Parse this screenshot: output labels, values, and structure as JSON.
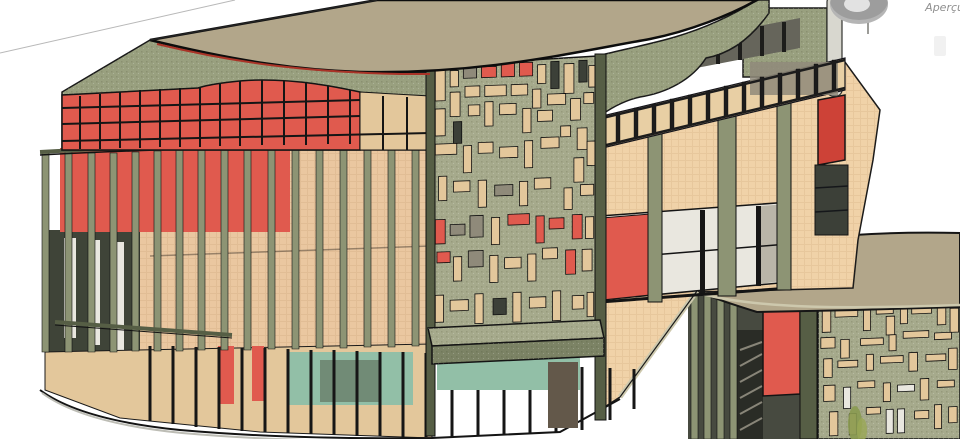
{
  "overlay": {
    "preview_label": "Aperçu",
    "preview_icon": "steering-wheel-icon"
  },
  "palette": {
    "bg": "#ffffff",
    "refline": "#b8b8b8",
    "roof": "#b2a68a",
    "roof_edge": "#0d0d0d",
    "fascia": "#99a07f",
    "fascia_dark": "#7c8365",
    "olive_panel": "#a6aa8c",
    "fin": "#8d9474",
    "fin_dark": "#565e45",
    "peach": "#f0d2a8",
    "peach_wall": "#eac7a0",
    "tan": "#e3c79b",
    "red": "#e05a4e",
    "red_bright": "#cd4237",
    "red_trim": "#a93327",
    "gray_panel": "#8f8a7a",
    "dark_glass": "#3c4038",
    "interior_dark": "#3f4438",
    "teal": "#92bfa7",
    "white_glass": "#e9e7df",
    "pole": "#d8d7cf",
    "slab": "#cdc8ad",
    "door_dark": "#63584a",
    "plant": "#8a9a50",
    "railing_peach": "#e8cfa4",
    "rail_dark": "#22231f",
    "facade2_bg": "#474a40",
    "ui_gray": "#9d9d9d",
    "ui_text": "#8f8f8f"
  },
  "generated": {
    "fins1": [
      [
        42,
        152,
        352
      ],
      [
        65,
        152,
        352
      ],
      [
        88,
        153,
        352
      ],
      [
        110,
        153,
        352
      ],
      [
        132,
        152,
        351
      ],
      [
        154,
        151,
        351
      ],
      [
        176,
        150,
        351
      ],
      [
        198,
        150,
        350
      ],
      [
        221,
        149,
        350
      ],
      [
        244,
        148,
        350
      ],
      [
        268,
        148,
        349
      ],
      [
        292,
        147,
        349
      ],
      [
        316,
        147,
        348
      ],
      [
        340,
        146,
        348
      ],
      [
        364,
        146,
        347
      ],
      [
        388,
        145,
        347
      ],
      [
        412,
        145,
        346
      ]
    ],
    "fins2": [
      [
        691,
        293,
        439
      ],
      [
        704,
        295,
        439
      ],
      [
        717,
        297,
        439
      ],
      [
        730,
        299,
        439
      ]
    ],
    "clerestory_verticals": [
      [
        80,
        96,
        149
      ],
      [
        100,
        94,
        149
      ],
      [
        120,
        92,
        148
      ],
      [
        140,
        90,
        148
      ],
      [
        160,
        89,
        147
      ],
      [
        180,
        88,
        147
      ],
      [
        200,
        87,
        147
      ],
      [
        220,
        84,
        146
      ],
      [
        240,
        81,
        146
      ],
      [
        262,
        80,
        145
      ],
      [
        284,
        81,
        145
      ],
      [
        306,
        83,
        145
      ],
      [
        328,
        86,
        144
      ],
      [
        350,
        90,
        144
      ]
    ],
    "clerestory_horizontals": [
      [
        62,
        108,
        360,
        100
      ],
      [
        62,
        124,
        360,
        116
      ],
      [
        62,
        141,
        430,
        133
      ]
    ],
    "railing_posts": [
      [
        598,
        117
      ],
      [
        616,
        113
      ],
      [
        634,
        108
      ],
      [
        652,
        104
      ],
      [
        670,
        99
      ],
      [
        688,
        95
      ],
      [
        706,
        91
      ],
      [
        724,
        86
      ],
      [
        742,
        82
      ],
      [
        760,
        77
      ],
      [
        778,
        73
      ],
      [
        796,
        69
      ],
      [
        814,
        64
      ],
      [
        832,
        60
      ]
    ],
    "storefront_mullions": [
      [
        150,
        346,
        421
      ],
      [
        173,
        346,
        424
      ],
      [
        196,
        347,
        427
      ],
      [
        219,
        347,
        429
      ],
      [
        242,
        348,
        431
      ],
      [
        265,
        348,
        432
      ],
      [
        288,
        349,
        433
      ],
      [
        311,
        350,
        434
      ],
      [
        334,
        350,
        435
      ],
      [
        357,
        351,
        436
      ],
      [
        380,
        352,
        436
      ],
      [
        403,
        352,
        437
      ],
      [
        426,
        353,
        437
      ],
      [
        452,
        362,
        437
      ],
      [
        478,
        363,
        436
      ],
      [
        504,
        364,
        435
      ],
      [
        530,
        365,
        434
      ],
      [
        556,
        366,
        432
      ],
      [
        582,
        367,
        430
      ],
      [
        610,
        368,
        420
      ],
      [
        634,
        369,
        409
      ]
    ],
    "stair_steps": [
      [
        740,
        430,
        762,
        418
      ],
      [
        740,
        414,
        762,
        402
      ],
      [
        740,
        398,
        762,
        386
      ],
      [
        740,
        382,
        762,
        370
      ],
      [
        740,
        366,
        762,
        354
      ],
      [
        740,
        350,
        762,
        342
      ]
    ],
    "panel1": {
      "transform": "matrix(1.65,-0.061,0,2.7,432,66)",
      "rects": [
        [
          2,
          1,
          6,
          12,
          "t"
        ],
        [
          11,
          2,
          5,
          6,
          "t"
        ],
        [
          19,
          1,
          8,
          4,
          "g"
        ],
        [
          30,
          1,
          9,
          4,
          "r"
        ],
        [
          42,
          0,
          8,
          5,
          "r"
        ],
        [
          53,
          0,
          8,
          5,
          "r"
        ],
        [
          64,
          1,
          5,
          7,
          "t"
        ],
        [
          72,
          0,
          5,
          10,
          "d"
        ],
        [
          80,
          1,
          6,
          11,
          "t"
        ],
        [
          89,
          0,
          5,
          8,
          "d"
        ],
        [
          95,
          2,
          4,
          8,
          "t"
        ],
        [
          11,
          10,
          6,
          9,
          "t"
        ],
        [
          20,
          8,
          9,
          4,
          "t"
        ],
        [
          32,
          8,
          13,
          4,
          "t"
        ],
        [
          48,
          8,
          10,
          4,
          "t"
        ],
        [
          61,
          10,
          5,
          7,
          "t"
        ],
        [
          70,
          12,
          11,
          4,
          "t"
        ],
        [
          84,
          14,
          6,
          8,
          "t"
        ],
        [
          92,
          12,
          6,
          4,
          "t"
        ],
        [
          2,
          16,
          6,
          10,
          "t"
        ],
        [
          13,
          21,
          5,
          8,
          "d"
        ],
        [
          22,
          15,
          7,
          4,
          "t"
        ],
        [
          32,
          14,
          5,
          9,
          "t"
        ],
        [
          41,
          15,
          10,
          4,
          "t"
        ],
        [
          55,
          17,
          5,
          9,
          "t"
        ],
        [
          64,
          18,
          9,
          4,
          "t"
        ],
        [
          78,
          24,
          6,
          4,
          "t"
        ],
        [
          88,
          25,
          6,
          8,
          "t"
        ],
        [
          2,
          29,
          13,
          4,
          "t"
        ],
        [
          19,
          30,
          5,
          10,
          "t"
        ],
        [
          28,
          29,
          9,
          4,
          "t"
        ],
        [
          41,
          31,
          11,
          4,
          "t"
        ],
        [
          56,
          29,
          5,
          10,
          "t"
        ],
        [
          66,
          28,
          11,
          4,
          "t"
        ],
        [
          86,
          36,
          6,
          9,
          "t"
        ],
        [
          94,
          30,
          5,
          9,
          "t"
        ],
        [
          4,
          41,
          5,
          9,
          "t"
        ],
        [
          13,
          43,
          10,
          4,
          "t"
        ],
        [
          28,
          43,
          5,
          10,
          "t"
        ],
        [
          38,
          45,
          11,
          4,
          "g"
        ],
        [
          53,
          44,
          5,
          9,
          "t"
        ],
        [
          62,
          43,
          10,
          4,
          "t"
        ],
        [
          80,
          47,
          5,
          8,
          "t"
        ],
        [
          90,
          46,
          8,
          4,
          "t"
        ],
        [
          2,
          57,
          6,
          9,
          "r"
        ],
        [
          11,
          59,
          9,
          4,
          "g"
        ],
        [
          23,
          56,
          8,
          8,
          "g"
        ],
        [
          36,
          57,
          5,
          10,
          "t"
        ],
        [
          46,
          56,
          13,
          4,
          "r"
        ],
        [
          63,
          57,
          5,
          10,
          "r"
        ],
        [
          71,
          58,
          9,
          4,
          "r"
        ],
        [
          85,
          57,
          6,
          9,
          "r"
        ],
        [
          93,
          58,
          5,
          8,
          "t"
        ],
        [
          3,
          69,
          8,
          4,
          "r"
        ],
        [
          13,
          71,
          5,
          9,
          "t"
        ],
        [
          22,
          69,
          9,
          6,
          "g"
        ],
        [
          35,
          71,
          5,
          10,
          "t"
        ],
        [
          44,
          72,
          10,
          4,
          "t"
        ],
        [
          58,
          71,
          5,
          10,
          "t"
        ],
        [
          67,
          69,
          9,
          4,
          "t"
        ],
        [
          81,
          70,
          6,
          9,
          "r"
        ],
        [
          91,
          70,
          6,
          8,
          "t"
        ],
        [
          2,
          85,
          5,
          10,
          "t"
        ],
        [
          11,
          87,
          11,
          4,
          "t"
        ],
        [
          26,
          85,
          5,
          11,
          "t"
        ],
        [
          37,
          87,
          8,
          6,
          "d"
        ],
        [
          49,
          85,
          5,
          11,
          "t"
        ],
        [
          59,
          87,
          10,
          4,
          "t"
        ],
        [
          73,
          85,
          5,
          11,
          "t"
        ],
        [
          85,
          87,
          7,
          5,
          "t"
        ],
        [
          94,
          86,
          4,
          9,
          "t"
        ]
      ]
    },
    "panel2": {
      "transform": "matrix(1.42,-0.06,0,1.33,818,306)",
      "rects": [
        [
          3,
          4,
          6,
          16,
          "t"
        ],
        [
          12,
          3,
          16,
          6,
          "t"
        ],
        [
          32,
          2,
          5,
          18,
          "t"
        ],
        [
          41,
          3,
          12,
          5,
          "t"
        ],
        [
          48,
          10,
          6,
          14,
          "t"
        ],
        [
          58,
          2,
          5,
          14,
          "t"
        ],
        [
          66,
          4,
          14,
          5,
          "t"
        ],
        [
          84,
          2,
          6,
          16,
          "t"
        ],
        [
          93,
          6,
          6,
          18,
          "t"
        ],
        [
          2,
          24,
          10,
          8,
          "t"
        ],
        [
          16,
          26,
          6,
          14,
          "t"
        ],
        [
          30,
          26,
          16,
          5,
          "t"
        ],
        [
          50,
          24,
          5,
          12,
          "t"
        ],
        [
          60,
          22,
          18,
          5,
          "t"
        ],
        [
          82,
          24,
          12,
          5,
          "t"
        ],
        [
          4,
          40,
          6,
          14,
          "t"
        ],
        [
          14,
          42,
          14,
          5,
          "t"
        ],
        [
          34,
          38,
          5,
          12,
          "t"
        ],
        [
          44,
          40,
          16,
          5,
          "t"
        ],
        [
          64,
          38,
          6,
          14,
          "t"
        ],
        [
          76,
          40,
          14,
          5,
          "t"
        ],
        [
          92,
          36,
          6,
          16,
          "t"
        ],
        [
          4,
          60,
          8,
          12,
          "t"
        ],
        [
          18,
          62,
          5,
          16,
          "w"
        ],
        [
          28,
          58,
          12,
          5,
          "t"
        ],
        [
          46,
          60,
          5,
          14,
          "t"
        ],
        [
          56,
          62,
          12,
          5,
          "w"
        ],
        [
          72,
          58,
          6,
          16,
          "t"
        ],
        [
          84,
          60,
          12,
          5,
          "t"
        ],
        [
          8,
          80,
          6,
          18,
          "t"
        ],
        [
          22,
          82,
          5,
          16,
          "t"
        ],
        [
          34,
          78,
          10,
          5,
          "t"
        ],
        [
          48,
          80,
          5,
          18,
          "w"
        ],
        [
          56,
          80,
          5,
          18,
          "w"
        ],
        [
          68,
          82,
          10,
          6,
          "t"
        ],
        [
          82,
          78,
          5,
          18,
          "t"
        ],
        [
          92,
          80,
          6,
          12,
          "t"
        ]
      ]
    }
  }
}
